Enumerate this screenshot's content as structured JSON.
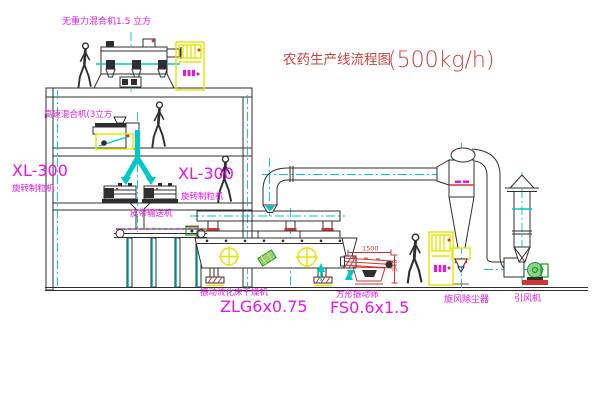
{
  "title": {
    "text": "农药生产线流程图",
    "capacity": "(500kg/h)"
  },
  "labels": {
    "gravity_mixer": "无重力混合机1.5 立方",
    "high_speed_mixer": "高速混合机(3立方",
    "granulator_left_model": "XL-300",
    "granulator_left_name": "旋转制粒机",
    "granulator_right_model": "XL-300",
    "granulator_right_name": "旋转制粒机",
    "belt_conveyor": "皮带输送机",
    "fluid_bed_dryer": "振动流化床干燥机",
    "fluid_bed_dryer_model": "ZLG6x0.75",
    "square_sieve": "方形振动筛",
    "square_sieve_model": "FS0.6x1.5",
    "cyclone": "旋风除尘器",
    "induced_draft_fan": "引风机",
    "dim_length": "1500",
    "dim_height": "340"
  },
  "colors": {
    "background": "#ffffff",
    "line": "#2f2f2f",
    "centerline_cyan": "#00c8c8",
    "label_magenta": "#e714e7",
    "title_red": "#cf4040",
    "dimension_red": "#d23333",
    "cabinet_yellow": "#e3e300",
    "machine_green": "#189c18"
  }
}
